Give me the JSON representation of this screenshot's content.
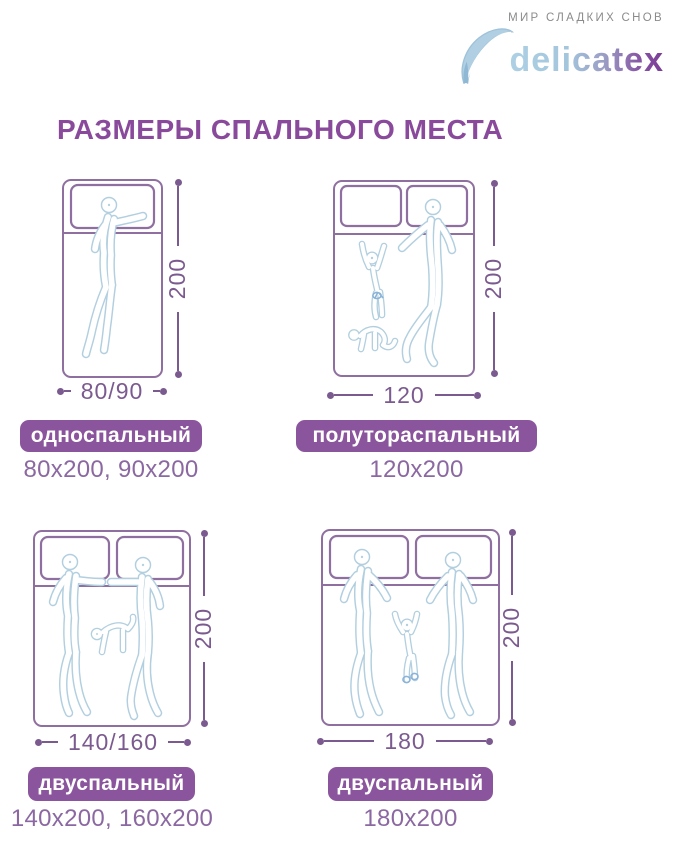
{
  "brand": {
    "tagline": "МИР СЛАДКИХ СНОВ",
    "name": "delicatex"
  },
  "title": "РАЗМЕРЫ СПАЛЬНОГО МЕСТА",
  "beds": [
    {
      "label": "односпальный",
      "sizes": "80x200, 90x200",
      "width_dim": "80/90",
      "height_dim": "200",
      "pillows": 1,
      "figures": [
        "woman-figure"
      ]
    },
    {
      "label": "полутораспальный",
      "sizes": "120x200",
      "width_dim": "120",
      "height_dim": "200",
      "pillows": 2,
      "figures": [
        "adult-figure",
        "child-figure",
        "cat-figure"
      ]
    },
    {
      "label": "двуспальный",
      "sizes": "140x200, 160x200",
      "width_dim": "140/160",
      "height_dim": "200",
      "pillows": 2,
      "figures": [
        "man-figure",
        "woman-figure",
        "dog-figure"
      ]
    },
    {
      "label": "двуспальный",
      "sizes": "180x200",
      "width_dim": "180",
      "height_dim": "200",
      "pillows": 2,
      "figures": [
        "man-figure",
        "woman-figure",
        "baby-figure"
      ]
    }
  ],
  "colors": {
    "title_purple": "#8a4a9b",
    "badge_purple": "#8a559c",
    "bed_outline_purple": "#8f6fa0",
    "dimension_purple": "#7b5a8f",
    "figure_blue": "#b2cfdf",
    "sizes_text_purple": "#8b68a1",
    "tagline_gray": "#8b8b8b",
    "brand_gradient_start": "#aed0e4",
    "brand_gradient_end": "#7a3b96"
  }
}
